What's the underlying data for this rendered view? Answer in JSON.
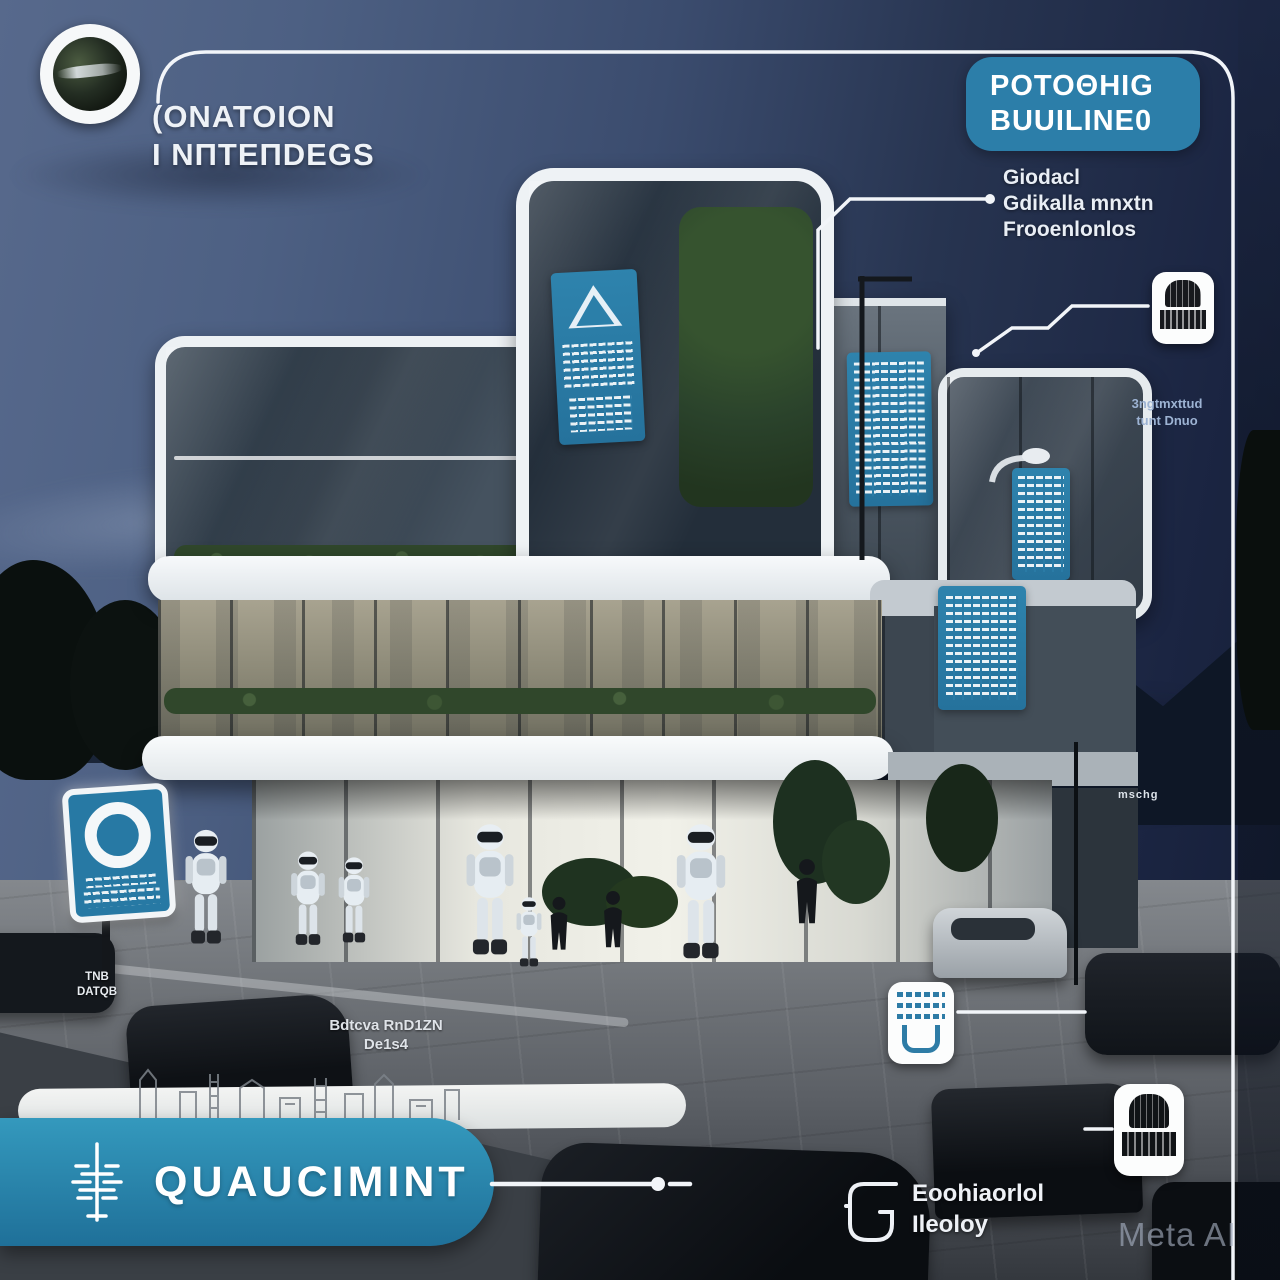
{
  "watermark": "Meta AI",
  "header": {
    "title_line1": "(ONATOION",
    "title_line2": "I NПTEПDEGS"
  },
  "top_right_callout": {
    "badge_line1": "POTOΘHIG",
    "badge_line2": "BUUILINE0",
    "desc_line1": "Giodacl",
    "desc_line2": "Gdikalla mnxtn",
    "desc_line3": "Frooenlonlos"
  },
  "right_callout": {
    "label_line1": "3ngtmxttud",
    "label_line2": "tunt Dnuo"
  },
  "left_label": {
    "line1": "TNB",
    "line2": "DATQB"
  },
  "plaza_label": {
    "line1": "Bdtcva RnD1ZN",
    "line2": "De1s4"
  },
  "scene": {
    "distant_sign": "mschg"
  },
  "banner": {
    "label": "QUAUCIMINT"
  },
  "bottom_right_callout": {
    "line1": "Eoohiaorlol",
    "line2": "Ileoloy"
  },
  "colors": {
    "accent_teal": "#2c7ea9",
    "banner_teal": "#2b8db3",
    "sign_blue": "#2779a4",
    "label_blue": "#9db3d3",
    "line_white": "#f2f5f9"
  }
}
